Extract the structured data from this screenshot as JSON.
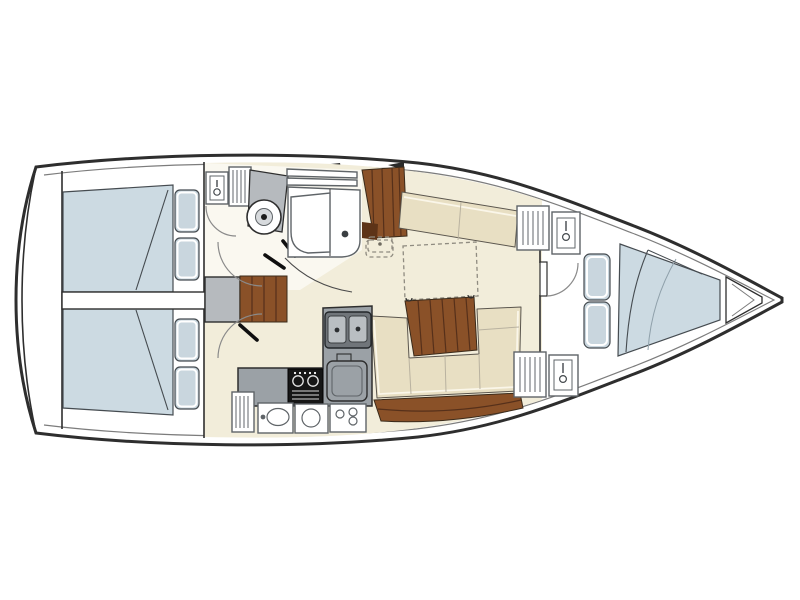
{
  "diagram": {
    "type": "boat-floorplan",
    "description": "Top-down interior layout plan of a sailing yacht, bow pointing right",
    "areas": [
      "stern-transom",
      "lazarette",
      "aft-cabin-top",
      "aft-cabin-bottom",
      "companionway-steps",
      "head-compartment",
      "shower-stall",
      "galley",
      "chart-table",
      "salon",
      "saloon-table",
      "settee-top",
      "settee-u-bottom",
      "forward-cabin",
      "v-berth",
      "bow-anchor-locker"
    ],
    "fixtures": [
      "toilet",
      "washbasin",
      "double-sink",
      "stove",
      "fridge",
      "hanging-lockers",
      "pillows",
      "door-swings"
    ]
  },
  "colors": {
    "hull_outline": "#2e2e2e",
    "deck_white": "#ffffff",
    "salon_floor": "#f2edda",
    "head_floor": "#faf8f0",
    "mattress_blue": "#ccdae2",
    "pillow_blue": "#c9d6de",
    "cushion_cream": "#e8dfc3",
    "wood_brown": "#8a5128",
    "wood_dark": "#5d3317",
    "counter_gray": "#9ba1a6",
    "counter_dark": "#70757a",
    "basin_gray": "#b9bec2",
    "panel_gray": "#b6babe",
    "appliance_black": "#161616"
  }
}
